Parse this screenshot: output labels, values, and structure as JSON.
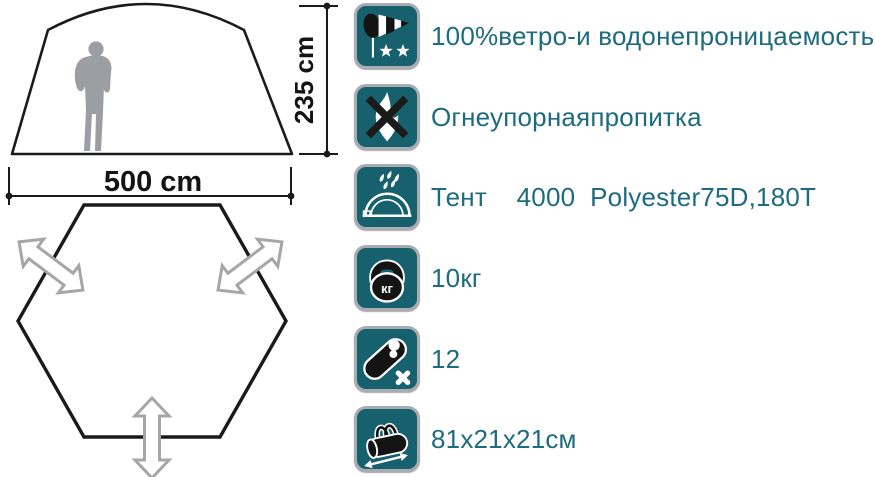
{
  "diagram": {
    "height_label": "235 cm",
    "width_label": "500 cm",
    "tent_outline_color": "#1b1b1b",
    "person_color": "#9b9ea2",
    "arrow_color": "#a6a6a6"
  },
  "specs": {
    "tile_background_color": "#16616d",
    "text_color": "#1d6b7f",
    "rows": [
      {
        "icon": "windsock-icon",
        "label": "100%ветро-и водонепроницаемость"
      },
      {
        "icon": "no-fire-icon",
        "label": "Огнеупорнаяпропитка"
      },
      {
        "icon": "tent-rain-icon",
        "label": "Тент    4000  Polyester75D,180T"
      },
      {
        "icon": "weight-icon",
        "label": "10кг",
        "icon_text": "кг"
      },
      {
        "icon": "sleeping-bag-icon",
        "label": "12"
      },
      {
        "icon": "carry-bag-icon",
        "label": "81x21x21см"
      }
    ]
  }
}
